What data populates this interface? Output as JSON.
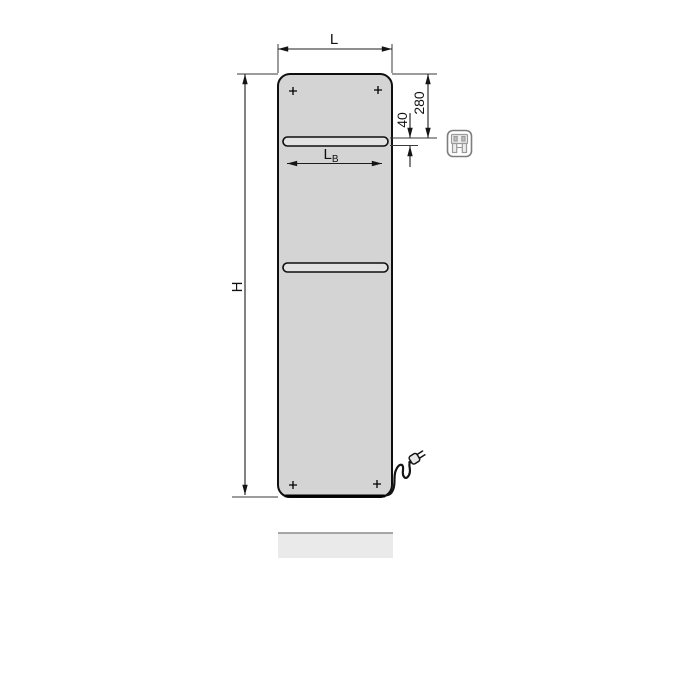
{
  "title": "Electric flat panel radiator - dimension drawing",
  "dimensions": {
    "width_label": "L",
    "height_label": "H",
    "rail_top_offset": "280",
    "rail_slot_height": "40",
    "bar_width_main": "L",
    "bar_width_sub": "B"
  },
  "icons": {
    "electric_badge": "electric-plug-badge-icon",
    "power_plug": "power-cord-plug-icon",
    "screw": "screw-cross-icon"
  },
  "colors": {
    "line": "#1c1c1c",
    "panel-fill": "#d4d4d4",
    "panel-stroke": "#0f0f0f",
    "rail-fill": "#e3e3e3",
    "floor-fill": "#eaeaea",
    "floor-edge": "#8c8c8c",
    "icon-stroke": "#7d7d7d",
    "bg": "#ffffff"
  }
}
